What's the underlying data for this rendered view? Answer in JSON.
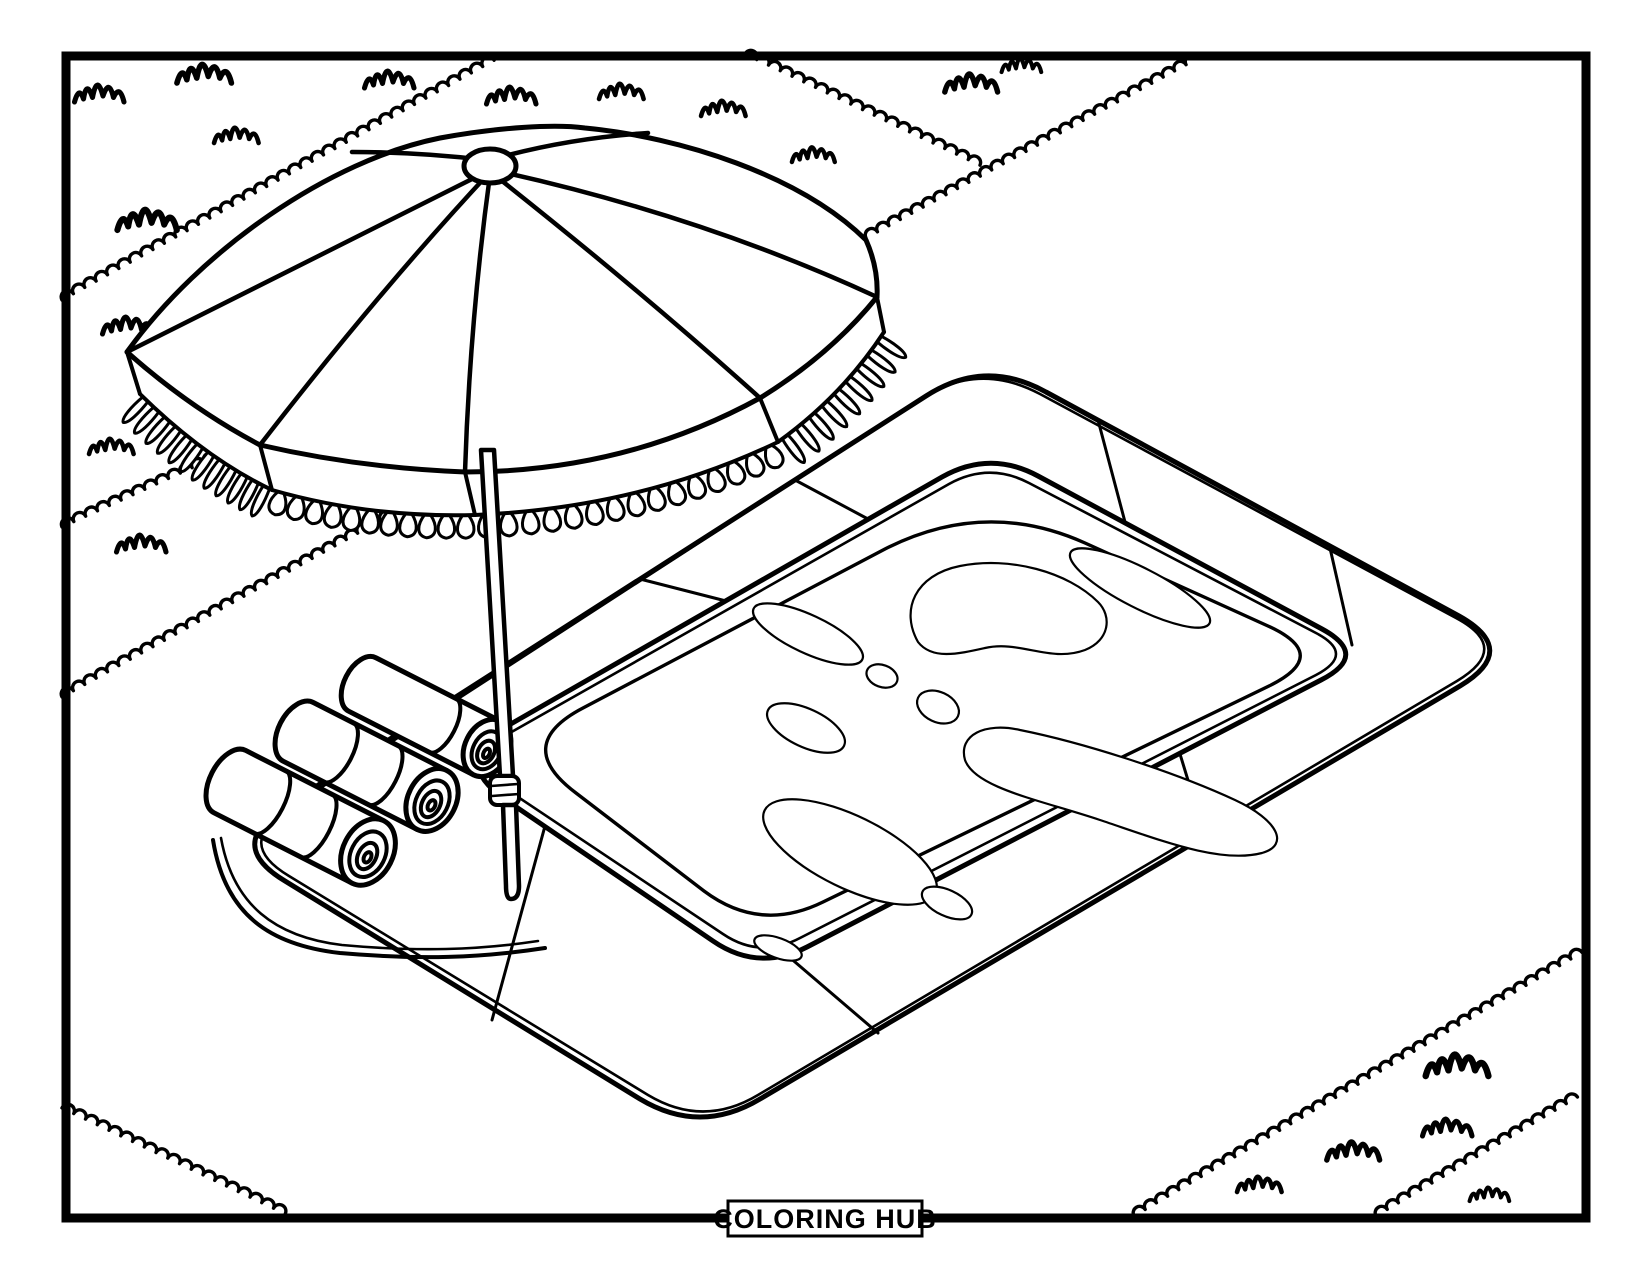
{
  "footer": {
    "brand": "COLORING HUB"
  },
  "artwork": {
    "style": "black-and-white line art coloring page",
    "colors": {
      "line": "#000000",
      "background": "#ffffff"
    },
    "scene": {
      "elements": [
        "beach-umbrella-with-fringe",
        "umbrella-pole",
        "isometric-swimming-pool",
        "pool-deck-tiles",
        "water-reflection-blobs",
        "rolled-towels",
        "towel-mat",
        "grass-strips-with-zigzag-borders",
        "grass-tufts",
        "page-frame-border"
      ]
    }
  }
}
